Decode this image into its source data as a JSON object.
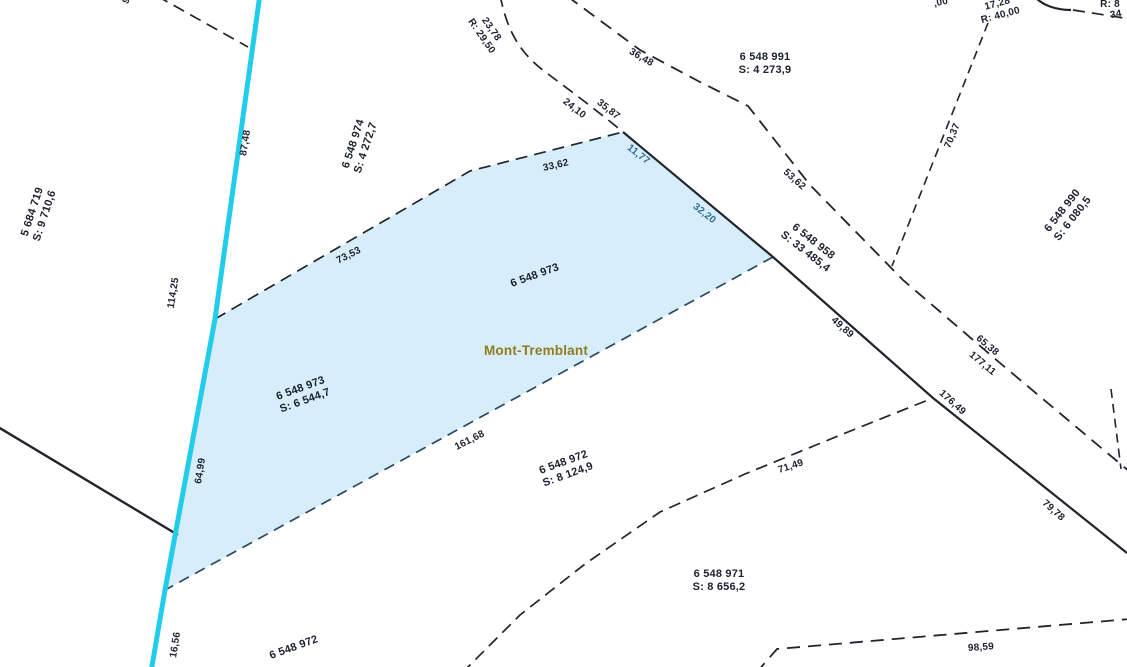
{
  "map": {
    "municipality": "Mont-Tremblant",
    "selected_parcel": {
      "id": "6 548 973",
      "area": "S: 6 544,7"
    },
    "parcels": [
      {
        "id": "5 684 719",
        "area": "S: 9 710,6"
      },
      {
        "id": "6 548 974",
        "area": "S: 4 272,7"
      },
      {
        "id": "6 548 991",
        "area": "S: 4 273,9"
      },
      {
        "id": "6 548 990",
        "area": "S: 6 080,5"
      },
      {
        "id": "6 548 958",
        "area": "S: 33 485,4"
      },
      {
        "id": "6 548 973",
        "area": "S: 6 544,7"
      },
      {
        "id": "6 548 972",
        "area": "S: 8 124,9"
      },
      {
        "id": "6 548 971",
        "area": "S: 8 656,2"
      }
    ],
    "colors": {
      "bg": "#ffffff",
      "line": "#20242c",
      "lowline": "#274a66",
      "cyan": "#22cdec",
      "parcel_fill": "#d7eefa",
      "label": "#1c2130",
      "dim_selected": "#2c6e91",
      "municipality_label": "#8e7c1f"
    },
    "labels": [
      {
        "name": "dim-87-48",
        "text": "87,48",
        "x": 246,
        "y": 143,
        "rot": -81,
        "cls": "dim"
      },
      {
        "name": "dim-114-25",
        "text": "114,25",
        "x": 174,
        "y": 293,
        "rot": -81,
        "cls": "dim"
      },
      {
        "name": "dim-64-99",
        "text": "64,99",
        "x": 201,
        "y": 471,
        "rot": -81,
        "cls": "dim"
      },
      {
        "name": "dim-16-56",
        "text": "16,56",
        "x": 176,
        "y": 645,
        "rot": -81,
        "cls": "dim"
      },
      {
        "name": "dim-73-53",
        "text": "73,53",
        "x": 349,
        "y": 256,
        "rot": -27,
        "cls": "dim"
      },
      {
        "name": "dim-33-62",
        "text": "33,62",
        "x": 556,
        "y": 166,
        "rot": -13,
        "cls": "dim"
      },
      {
        "name": "dim-24-10",
        "text": "24,10",
        "x": 574,
        "y": 109,
        "rot": 38,
        "cls": "dim"
      },
      {
        "name": "dim-35-87",
        "text": "35,87",
        "x": 608,
        "y": 110,
        "rot": 38,
        "cls": "dim"
      },
      {
        "name": "arc-23-78",
        "lines": [
          "23,78",
          "R: 29,50"
        ],
        "x": 486,
        "y": 33,
        "rot": 55,
        "cls": "dim"
      },
      {
        "name": "dim-36-48",
        "text": "36,48",
        "x": 641,
        "y": 58,
        "rot": 30,
        "cls": "dim"
      },
      {
        "name": "dim-11-77",
        "text": "11,77",
        "x": 638,
        "y": 155,
        "rot": 38,
        "cls": "dim dim-sel"
      },
      {
        "name": "dim-32-20",
        "text": "32,20",
        "x": 704,
        "y": 214,
        "rot": 38,
        "cls": "dim dim-sel"
      },
      {
        "name": "dim-49-89",
        "text": "49,89",
        "x": 842,
        "y": 328,
        "rot": 42,
        "cls": "dim"
      },
      {
        "name": "dim-53-62",
        "text": "53,62",
        "x": 794,
        "y": 180,
        "rot": 42,
        "cls": "dim"
      },
      {
        "name": "dim-65-38",
        "text": "65,38",
        "x": 987,
        "y": 346,
        "rot": 40,
        "cls": "dim"
      },
      {
        "name": "dim-177-11",
        "text": "177,11",
        "x": 982,
        "y": 364,
        "rot": 40,
        "cls": "dim"
      },
      {
        "name": "dim-176-49",
        "text": "176,49",
        "x": 952,
        "y": 403,
        "rot": 42,
        "cls": "dim"
      },
      {
        "name": "dim-79-78",
        "text": "79,78",
        "x": 1053,
        "y": 511,
        "rot": 42,
        "cls": "dim"
      },
      {
        "name": "dim-70-37",
        "text": "70,37",
        "x": 953,
        "y": 136,
        "rot": -67,
        "cls": "dim"
      },
      {
        "name": "dim-71-49",
        "text": "71,49",
        "x": 791,
        "y": 467,
        "rot": -18,
        "cls": "dim"
      },
      {
        "name": "dim-98-59",
        "text": "98,59",
        "x": 981,
        "y": 648,
        "rot": -4,
        "cls": "dim"
      },
      {
        "name": "dim-161-68",
        "text": "161,68",
        "x": 470,
        "y": 441,
        "rot": -27,
        "cls": "dim"
      },
      {
        "name": "arc-17-28",
        "lines": [
          "17,28",
          "R: 40,00"
        ],
        "x": 999,
        "y": 10,
        "rot": -15,
        "cls": "dim"
      },
      {
        "name": "dim-frag-00",
        "text": ",00",
        "x": 941,
        "y": 3,
        "rot": -12,
        "cls": "dim"
      },
      {
        "name": "dim-frag-r8",
        "text": "R: 8",
        "x": 1110,
        "y": 5,
        "rot": 0,
        "cls": "dim"
      },
      {
        "name": "dim-frag-34",
        "text": "34",
        "x": 1116,
        "y": 15,
        "rot": -10,
        "cls": "dim"
      },
      {
        "name": "dim-frag-9",
        "text": "9",
        "x": 127,
        "y": 1,
        "rot": -60,
        "cls": "dim"
      },
      {
        "name": "lot-5684719",
        "lines": [
          "5 684 719",
          "S: 9 710,6"
        ],
        "x": 39,
        "y": 214,
        "rot": -72,
        "cls": "lot"
      },
      {
        "name": "lot-6548974",
        "lines": [
          "6 548 974",
          "S: 4 272,7"
        ],
        "x": 360,
        "y": 146,
        "rot": -72,
        "cls": "lot"
      },
      {
        "name": "lot-6548991",
        "lines": [
          "6 548 991",
          "S: 4 273,9"
        ],
        "x": 765,
        "y": 64,
        "rot": 0,
        "cls": "lot"
      },
      {
        "name": "lot-6548990",
        "lines": [
          "6 548 990",
          "S: 6 080,5"
        ],
        "x": 1068,
        "y": 215,
        "rot": -52,
        "cls": "lot"
      },
      {
        "name": "lot-6548958",
        "lines": [
          "6 548 958",
          "S: 33 485,4"
        ],
        "x": 809,
        "y": 247,
        "rot": 38,
        "cls": "lot"
      },
      {
        "name": "lot-6548973-number",
        "lines": [
          "6 548 973"
        ],
        "x": 535,
        "y": 276,
        "rot": -20,
        "cls": "lot"
      },
      {
        "name": "municipality-label",
        "text": "Mont-Tremblant",
        "x": 536,
        "y": 351,
        "rot": 0,
        "cls": "muni"
      },
      {
        "name": "lot-6548973-area",
        "lines": [
          "6 548 973",
          "S: 6 544,7"
        ],
        "x": 303,
        "y": 395,
        "rot": -20,
        "cls": "lot"
      },
      {
        "name": "lot-6548972",
        "lines": [
          "6 548 972",
          "S: 8 124,9"
        ],
        "x": 566,
        "y": 469,
        "rot": -20,
        "cls": "lot"
      },
      {
        "name": "lot-6548971",
        "lines": [
          "6 548 971",
          "S: 8 656,2"
        ],
        "x": 719,
        "y": 581,
        "rot": 0,
        "cls": "lot"
      },
      {
        "name": "lot-6548972-south",
        "lines": [
          "6 548 972"
        ],
        "x": 294,
        "y": 648,
        "rot": -20,
        "cls": "lot"
      }
    ]
  }
}
